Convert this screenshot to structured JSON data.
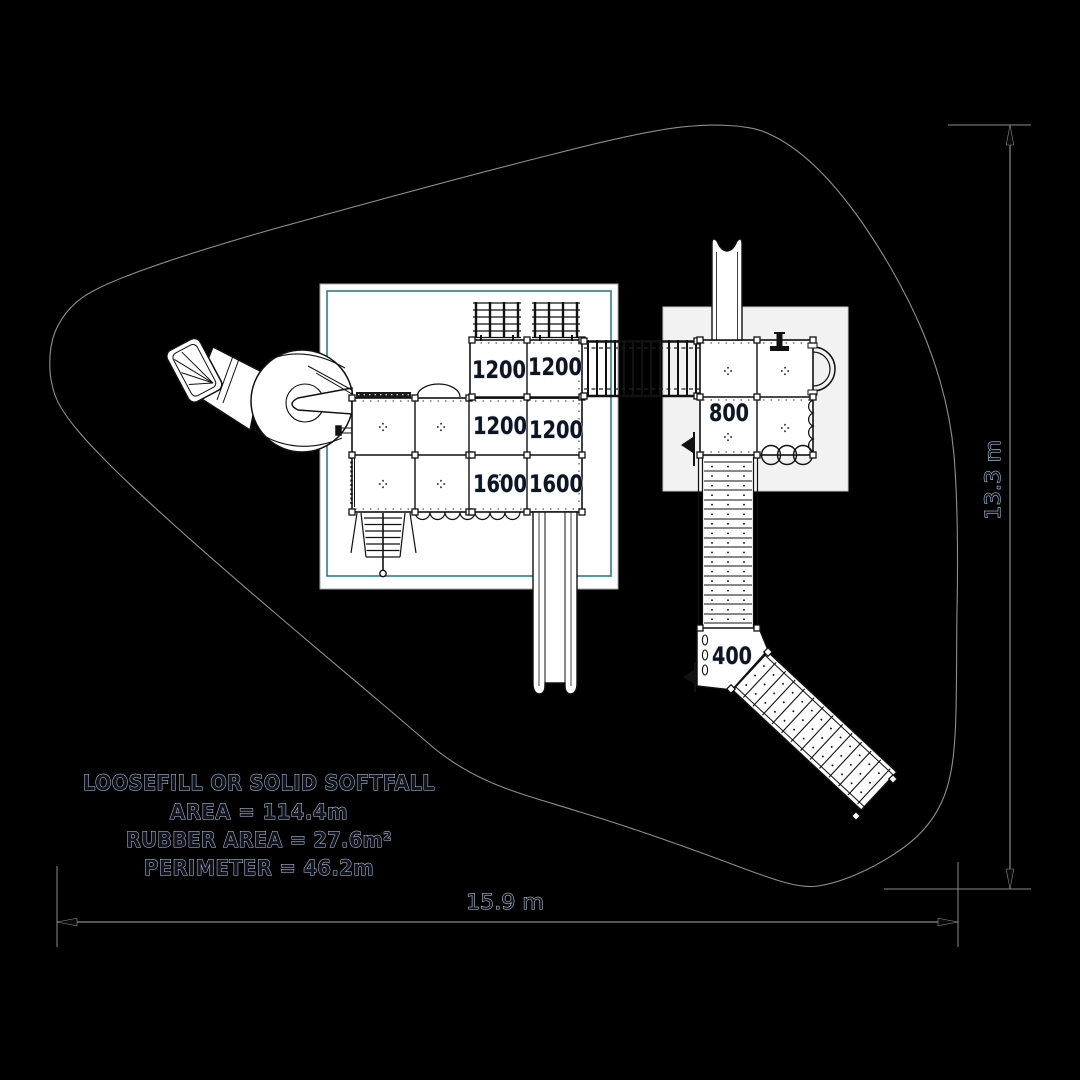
{
  "info_box": {
    "line1": "LOOSEFILL OR SOLID SOFTFALL",
    "line2": "AREA = 114.4m",
    "line3": "RUBBER AREA = 27.6m²",
    "line4": "PERIMETER = 46.2m"
  },
  "dims": {
    "width": "15.9 m",
    "height": "13.3 m"
  },
  "platforms": {
    "p1": "1200",
    "p2": "1200",
    "p3": "1200",
    "p4": "1200",
    "p5": "1600",
    "p6": "1600",
    "p7": "800",
    "p8": "400"
  },
  "colors": {
    "background": "#000000",
    "softfall_outline": "#8f8f8f",
    "dimension_line": "#8a8a8a",
    "equipment_ink": "#111111",
    "platform_fill": "#ffffff",
    "panel_a_border": "#2e7f82",
    "panel_b_fill": "#f2f2f2",
    "label_fill": "#10141f",
    "label_halo": "#c7d5ea"
  }
}
